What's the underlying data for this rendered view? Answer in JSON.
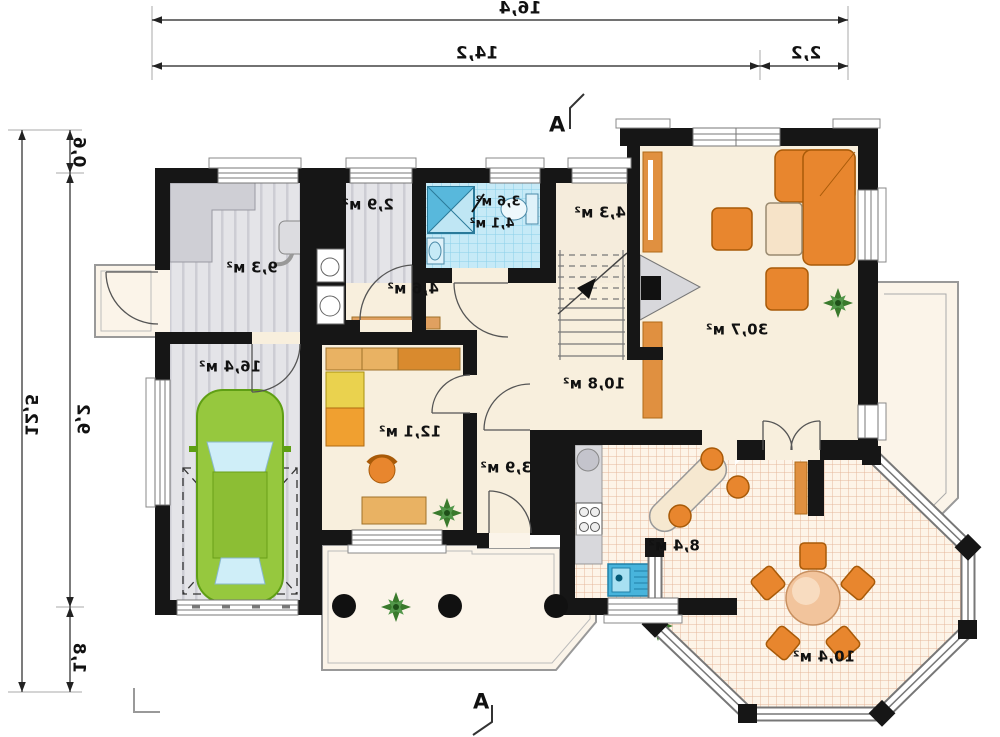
{
  "plan": {
    "section_marker_top": "A",
    "section_marker_bottom": "A",
    "dim_top_total": "16,4",
    "dim_top_main": "14,2",
    "dim_top_side": "2,2",
    "dim_left_total": "12,5",
    "dim_left_top": "0,6",
    "dim_left_mid": "9,2",
    "dim_left_bottom": "1,8",
    "rooms": {
      "utility": "9,3 м²",
      "wc": "2,9 м²",
      "bath_a": "3,6 м²",
      "bath_b": "4,1 м²",
      "stair_hall": "4,3 м²",
      "entry_hall": "4,6 м²",
      "garage": "16,4 м²",
      "office": "12,1 м²",
      "hall": "10,8 м²",
      "corridor": "3,9 м²",
      "living": "30,7 м²",
      "kitchen": "8,4 м²",
      "dining": "10,4 м²"
    },
    "colors": {
      "wall": "#161616",
      "floor_cream": "#f8efdd",
      "floor_gray": "#e3e3e7",
      "tile_blue": "#c6eaf7",
      "furniture_orange": "#e8862e",
      "car_green": "#96c83e",
      "plant_green": "#3a7a2c",
      "kitchen_grid": "#e0ab8d"
    }
  }
}
